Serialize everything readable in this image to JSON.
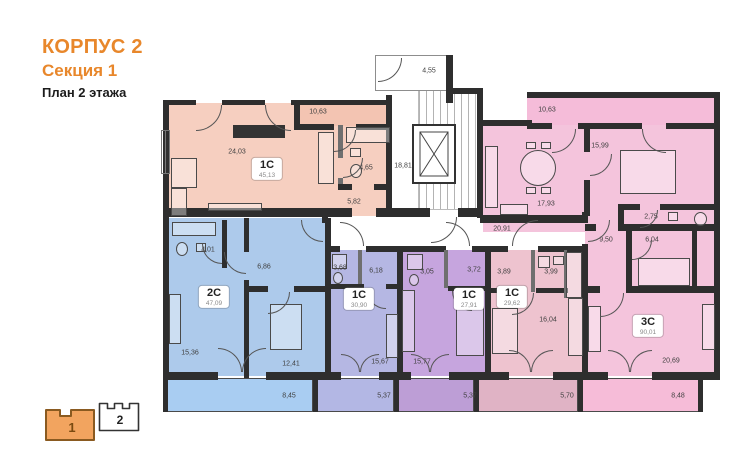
{
  "header": {
    "building": "КОРПУС 2",
    "section_label": "Секция 1",
    "floor_label": "План 2 этажа",
    "accent_color": "#e8872b"
  },
  "floor_selector": {
    "sections": [
      {
        "label": "1",
        "selected": true
      },
      {
        "label": "2",
        "selected": false
      }
    ],
    "selected_fill": "#f2a45f",
    "unselected_fill": "#ffffff"
  },
  "apartments": [
    {
      "id": "salmon",
      "type": "1С",
      "area": "45,13",
      "color": "#f6cfc0"
    },
    {
      "id": "blue",
      "type": "2С",
      "area": "47,09",
      "color": "#adcaeb"
    },
    {
      "id": "lavender",
      "type": "1С",
      "area": "30,90",
      "color": "#b5b7e3"
    },
    {
      "id": "purple",
      "type": "1С",
      "area": "27,91",
      "color": "#c6a5de"
    },
    {
      "id": "rose",
      "type": "1С",
      "area": "29,62",
      "color": "#eec3cf"
    },
    {
      "id": "pink3",
      "type": "3С",
      "area": "90,01",
      "color": "#f4c4dc"
    }
  ],
  "dims": {
    "salmon_balcony": "10,63",
    "salmon_room": "24,03",
    "salmon_bath": "4,65",
    "salmon_hall": "5,82",
    "vestibule": "4,55",
    "stairwell": "18,81",
    "corridor": "20,91",
    "pink3_balcony_top": "10,63",
    "pink3_bedroom": "15,99",
    "pink3_kitchen": "17,93",
    "pink3_wc": "2,75",
    "pink3_hall": "9,50",
    "pink3_bath": "6,04",
    "pink3_room": "20,69",
    "pink3_balcony_bottom": "8,48",
    "blue_bath": "4,01",
    "blue_hall": "6,86",
    "blue_room1": "15,36",
    "blue_room2": "12,41",
    "blue_balcony": "8,45",
    "lav_bath": "3,68",
    "lav_hall": "6,18",
    "lav_room": "15,67",
    "lav_balcony": "5,37",
    "pur_bath": "3,05",
    "pur_hall": "3,72",
    "pur_room": "15,77",
    "pur_balcony": "5,37",
    "rose_hall": "3,89",
    "rose_bath": "3,99",
    "rose_room": "16,04",
    "rose_balcony": "5,70"
  }
}
